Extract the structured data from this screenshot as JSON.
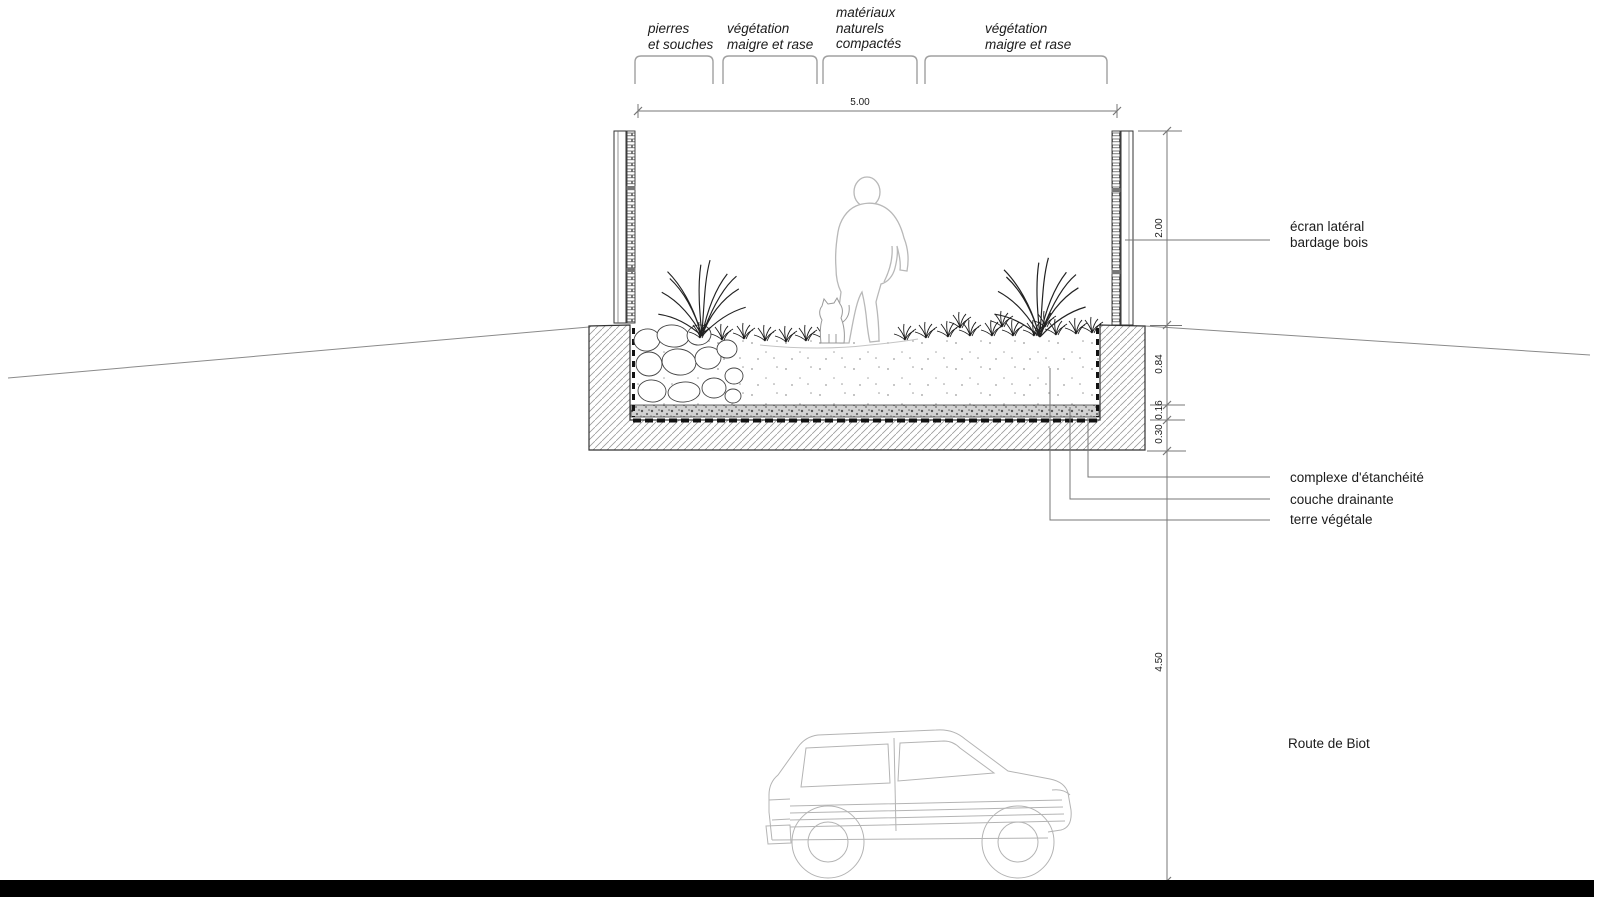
{
  "drawing_type": "road crossing cross-section (coupe) over Route de Biot",
  "zones": [
    {
      "lines": [
        "pierres",
        "et souches"
      ]
    },
    {
      "lines": [
        "végétation",
        "maigre et rase"
      ]
    },
    {
      "lines": [
        "matériaux",
        "naturels",
        "compactés"
      ]
    },
    {
      "lines": [
        "végétation",
        "maigre et rase"
      ]
    }
  ],
  "dimensions": {
    "deck_width": "5.00",
    "screen_height": "2.00",
    "soil_depth": "0.84",
    "drainage_thickness": "0.16",
    "slab_thickness": "0.30",
    "clearance": "4.50"
  },
  "labels": {
    "screen": {
      "lines": [
        "écran latéral",
        "bardage bois"
      ]
    },
    "waterproofing": "complexe d'étanchéité",
    "drainage": "couche drainante",
    "topsoil": "terre végétale",
    "road": "Route de Biot"
  },
  "colors": {
    "ink": "#1b1b1b",
    "dim_line": "#777777",
    "hatch": "#9b9b9b",
    "light_figure": "#b8b8b8",
    "road_bar": "#000000",
    "gravel_base": "#d2d2d2"
  }
}
